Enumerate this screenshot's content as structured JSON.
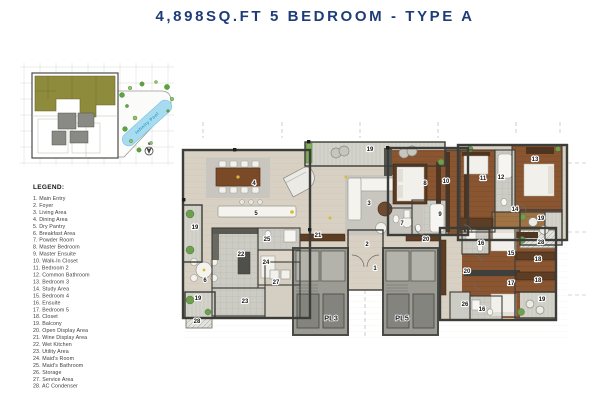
{
  "title": "4,898SQ.FT 5 BEDROOM - TYPE A",
  "colors": {
    "title_navy": "#1e3d78",
    "unit_olive": "#8e8b3d",
    "pool_blue": "#a7dbf0",
    "pool_text": "#2e9ec7",
    "wood_brown": "#8a5531",
    "floor_beige": "#d8d0c2"
  },
  "keyplan": {
    "pool_label": "Infinity Pool",
    "north_label": "N"
  },
  "legend": {
    "heading": "LEGEND:",
    "items": [
      "1. Main Entry",
      "2. Foyer",
      "3. Living Area",
      "4. Dining Area",
      "5. Dry Pantry",
      "6. Breakfast Area",
      "7. Powder Room",
      "8. Master Bedroom",
      "9. Master Ensuite",
      "10. Walk-In Closet",
      "11. Bedroom 2",
      "12. Common Bathroom",
      "13. Bedroom 3",
      "14. Study Area",
      "15. Bedroom 4",
      "16. Ensuite",
      "17. Bedroom 5",
      "18. Closet",
      "19. Balcony",
      "20. Open Display Area",
      "21. Wine Display Area",
      "22. Wet Kitchen",
      "23. Utility Area",
      "24. Maid's Room",
      "25. Maid's Bathroom",
      "26. Storage",
      "27. Service Area",
      "28. AC Condenser"
    ]
  },
  "floorplan": {
    "labels": [
      {
        "text": "1",
        "x": 197,
        "y": 147
      },
      {
        "text": "2",
        "x": 189,
        "y": 123
      },
      {
        "text": "3",
        "x": 191,
        "y": 82
      },
      {
        "text": "4",
        "x": 76,
        "y": 62
      },
      {
        "text": "5",
        "x": 78,
        "y": 92
      },
      {
        "text": "6",
        "x": 27,
        "y": 159
      },
      {
        "text": "7",
        "x": 224,
        "y": 102
      },
      {
        "text": "8",
        "x": 247,
        "y": 62
      },
      {
        "text": "9",
        "x": 262,
        "y": 93
      },
      {
        "text": "10",
        "x": 268,
        "y": 60
      },
      {
        "text": "11",
        "x": 305,
        "y": 57
      },
      {
        "text": "12",
        "x": 323,
        "y": 56
      },
      {
        "text": "13",
        "x": 357,
        "y": 38
      },
      {
        "text": "14",
        "x": 337,
        "y": 88
      },
      {
        "text": "15",
        "x": 333,
        "y": 132
      },
      {
        "text": "16",
        "x": 303,
        "y": 122
      },
      {
        "text": "16",
        "x": 304,
        "y": 188
      },
      {
        "text": "17",
        "x": 333,
        "y": 162
      },
      {
        "text": "18",
        "x": 360,
        "y": 138
      },
      {
        "text": "18",
        "x": 360,
        "y": 159
      },
      {
        "text": "19",
        "x": 192,
        "y": 28
      },
      {
        "text": "19",
        "x": 17,
        "y": 106
      },
      {
        "text": "19",
        "x": 363,
        "y": 97
      },
      {
        "text": "19",
        "x": 364,
        "y": 178
      },
      {
        "text": "19",
        "x": 20,
        "y": 177
      },
      {
        "text": "20",
        "x": 248,
        "y": 118
      },
      {
        "text": "20",
        "x": 289,
        "y": 150
      },
      {
        "text": "21",
        "x": 140,
        "y": 114
      },
      {
        "text": "22",
        "x": 63,
        "y": 133
      },
      {
        "text": "23",
        "x": 67,
        "y": 180
      },
      {
        "text": "24",
        "x": 88,
        "y": 141
      },
      {
        "text": "25",
        "x": 89,
        "y": 118
      },
      {
        "text": "26",
        "x": 287,
        "y": 183
      },
      {
        "text": "27",
        "x": 98,
        "y": 161
      },
      {
        "text": "28",
        "x": 19,
        "y": 200
      },
      {
        "text": "28",
        "x": 363,
        "y": 121
      },
      {
        "text": "PL3",
        "x": 153,
        "y": 196,
        "size": 8
      },
      {
        "text": "PL5",
        "x": 224,
        "y": 196,
        "size": 8
      }
    ]
  }
}
